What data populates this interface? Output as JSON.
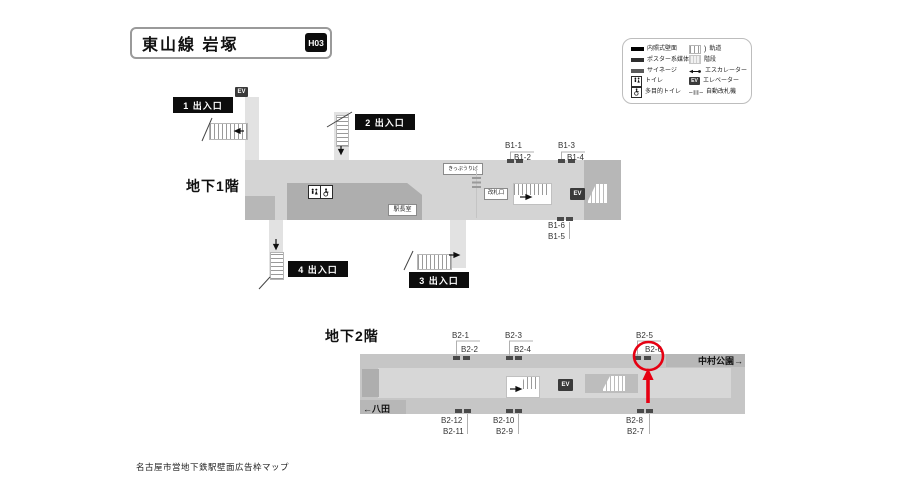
{
  "header": {
    "title": "東山線 岩塚",
    "station_code": "H03"
  },
  "legend": {
    "left": [
      {
        "name": "illuminated-wall",
        "label": "内照式壁面"
      },
      {
        "name": "poster-media",
        "label": "ポスター系媒体"
      },
      {
        "name": "signage",
        "label": "サイネージ"
      },
      {
        "name": "toilet",
        "label": "トイレ"
      },
      {
        "name": "accessible-toilet",
        "label": "多目的トイレ"
      }
    ],
    "right": [
      {
        "name": "track",
        "label": "軌道"
      },
      {
        "name": "stairs",
        "label": "階段"
      },
      {
        "name": "escalator",
        "label": "エスカレーター"
      },
      {
        "name": "elevator",
        "label": "エレベーター"
      },
      {
        "name": "ticket-gate",
        "label": "自動改札機"
      }
    ]
  },
  "b1": {
    "floor_label": "地下1階",
    "exits": {
      "e1": "1 出入口",
      "e2": "2 出入口",
      "e3": "3 出入口",
      "e4": "4 出入口"
    },
    "rooms": {
      "ticket_window": "きっぷうりば",
      "gate": "改札口",
      "station_master": "駅長室"
    },
    "ads": {
      "a1": "B1-1",
      "a2": "B1-2",
      "a3": "B1-3",
      "a4": "B1-4",
      "a5": "B1-5",
      "a6": "B1-6"
    }
  },
  "b2": {
    "floor_label": "地下2階",
    "direction_left": "←八田",
    "direction_right": "中村公園→",
    "ads": {
      "a1": "B2-1",
      "a2": "B2-2",
      "a3": "B2-3",
      "a4": "B2-4",
      "a5": "B2-5",
      "a6": "B2-6",
      "a7": "B2-7",
      "a8": "B2-8",
      "a9": "B2-9",
      "a10": "B2-10",
      "a11": "B2-11",
      "a12": "B2-12"
    },
    "highlighted_ad": "B2-6"
  },
  "ev_label": "EV",
  "footer": "名古屋市営地下鉄駅壁面広告枠マップ",
  "colors": {
    "highlight": "#e60012",
    "corridor": "#d4d4d4",
    "block": "#aeaeae"
  }
}
